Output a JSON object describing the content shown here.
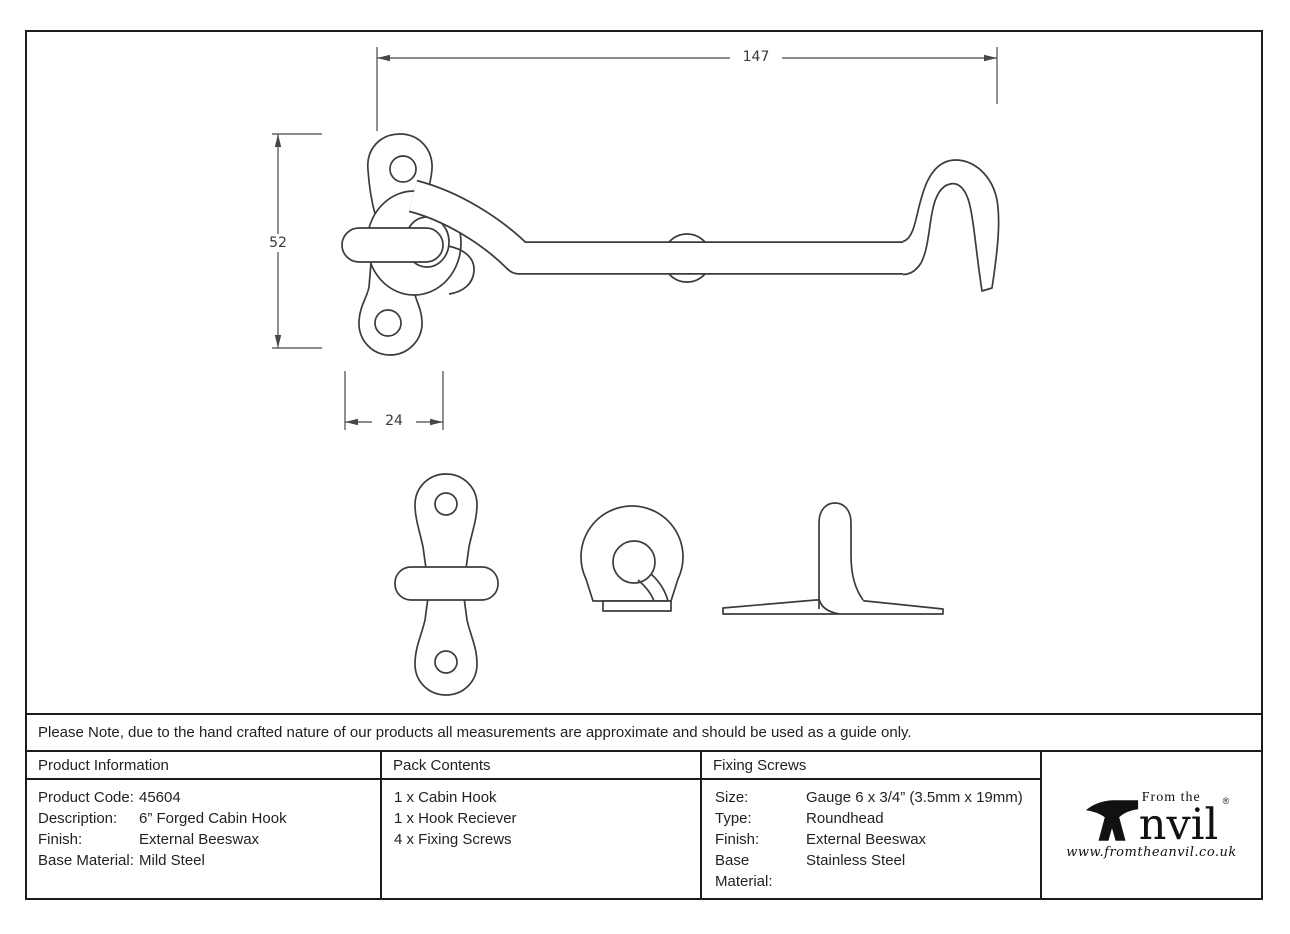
{
  "note": "Please Note, due to the hand crafted nature of our products all measurements are approximate and should be used as a guide only.",
  "drawing": {
    "dim_length": "147",
    "dim_height": "52",
    "dim_width": "24"
  },
  "product_information": {
    "title": "Product Information",
    "rows": [
      {
        "label": "Product Code:",
        "value": "45604"
      },
      {
        "label": "Description:",
        "value": "6” Forged Cabin Hook"
      },
      {
        "label": "Finish:",
        "value": "External Beeswax"
      },
      {
        "label": "Base Material:",
        "value": "Mild Steel"
      }
    ]
  },
  "pack_contents": {
    "title": "Pack Contents",
    "items": [
      "1 x Cabin Hook",
      "1 x Hook Reciever",
      "4 x Fixing Screws"
    ]
  },
  "fixing_screws": {
    "title": "Fixing Screws",
    "rows": [
      {
        "label": "Size:",
        "value": "Gauge 6 x 3/4” (3.5mm x 19mm)"
      },
      {
        "label": "Type:",
        "value": "Roundhead"
      },
      {
        "label": "Finish:",
        "value": "External Beeswax"
      },
      {
        "label": "Base Material:",
        "value": "Stainless Steel"
      }
    ]
  },
  "logo": {
    "prefix": "From the",
    "name_rest": "nvil",
    "registered": "®",
    "website": "www.fromtheanvil.co.uk"
  },
  "colors": {
    "line": "#3c3c3c",
    "border": "#1c1c1c",
    "text": "#222222"
  }
}
